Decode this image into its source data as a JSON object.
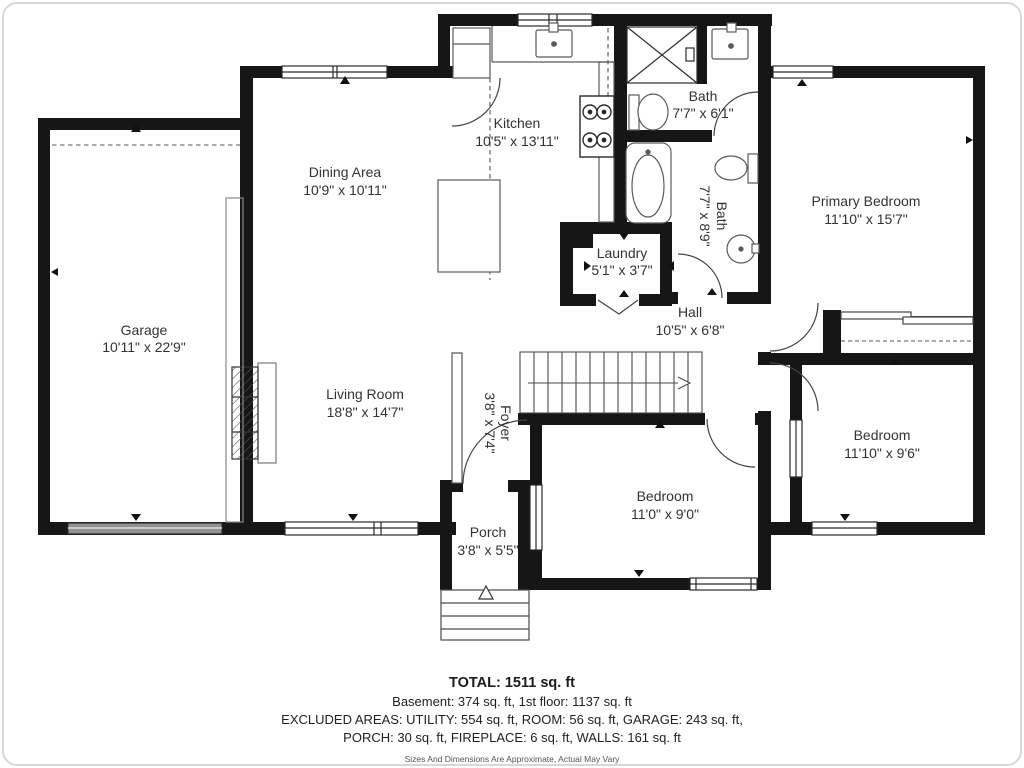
{
  "plan": {
    "title": "First floor plan",
    "rooms": {
      "kitchen": {
        "name": "Kitchen",
        "dims": "10'5\" x 13'11\""
      },
      "dining": {
        "name": "Dining Area",
        "dims": "10'9\" x 10'11\""
      },
      "garage": {
        "name": "Garage",
        "dims": "10'11\" x 22'9\""
      },
      "living": {
        "name": "Living Room",
        "dims": "18'8\" x 14'7\""
      },
      "bath_top": {
        "name": "Bath",
        "dims": "7'7\" x 6'1\""
      },
      "bath_main": {
        "name": "Bath",
        "dims": "7'7\" x 8'9\""
      },
      "laundry": {
        "name": "Laundry",
        "dims": "5'1\" x 3'7\""
      },
      "hall": {
        "name": "Hall",
        "dims": "10'5\" x 6'8\""
      },
      "primary": {
        "name": "Primary Bedroom",
        "dims": "11'10\" x 15'7\""
      },
      "bedroom_right": {
        "name": "Bedroom",
        "dims": "11'10\" x 9'6\""
      },
      "bedroom_middle": {
        "name": "Bedroom",
        "dims": "11'0\" x 9'0\""
      },
      "foyer": {
        "name": "Foyer",
        "dims": "3'8\" x 7'4\""
      },
      "porch": {
        "name": "Porch",
        "dims": "3'8\" x 5'5\""
      }
    },
    "summary": {
      "total": "TOTAL: 1511 sq. ft",
      "line2": "Basement: 374 sq. ft, 1st floor: 1137 sq. ft",
      "line3": "EXCLUDED AREAS: UTILITY: 554 sq. ft, ROOM: 56 sq. ft, GARAGE: 243 sq. ft,",
      "line4": "PORCH: 30 sq. ft, FIREPLACE: 6 sq. ft, WALLS: 161 sq. ft",
      "disclaimer": "Sizes And Dimensions Are Approximate, Actual May Vary"
    },
    "colors": {
      "wall": "#161616",
      "text": "#333333",
      "fixture": "#5a5a5a"
    }
  }
}
